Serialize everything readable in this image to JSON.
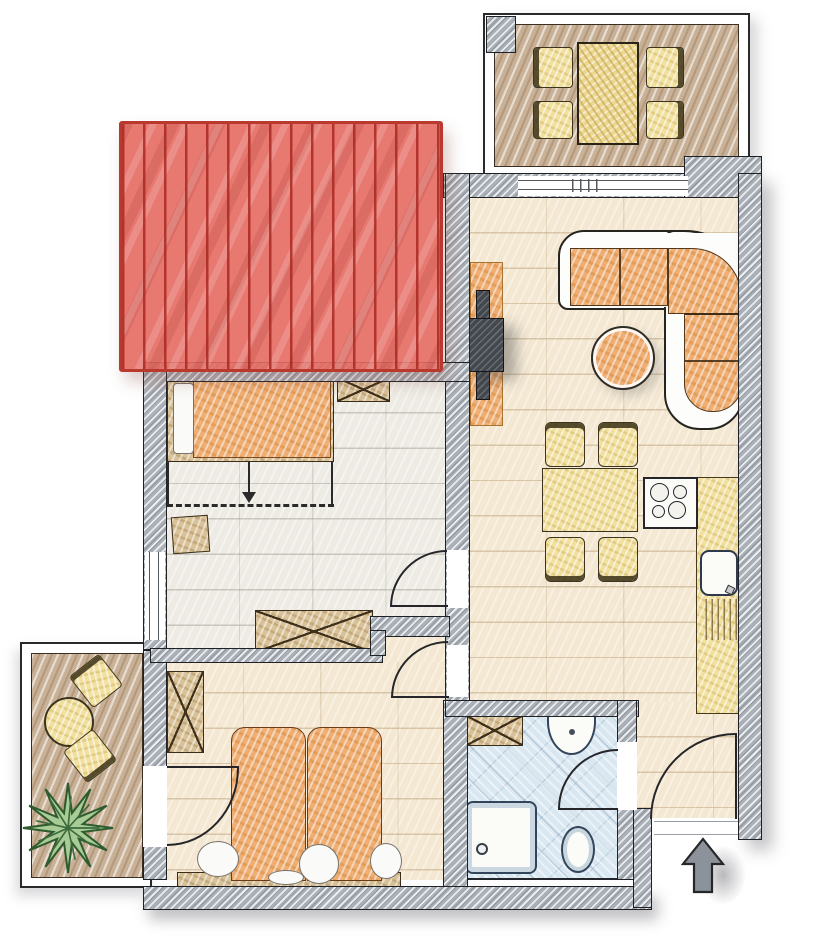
{
  "document": {
    "kind": "apartment floor plan drawing",
    "style": "hand-drawn colored architectural sketch, top view, no text labels"
  },
  "palette": {
    "wall_gray": "#aab0b8",
    "outline": "#26262a",
    "floor_living": "#f4e8d3",
    "floor_bedroom1": "#edebe4",
    "floor_bathroom": "#d9e7f1",
    "floor_deck": "#c9b197",
    "furniture_orange": "#efae73",
    "furniture_yellow": "#f2e09f",
    "furniture_wood": "#d9c298",
    "fixture_white": "#fbfbf8",
    "roof_red": "#e4665c",
    "roof_line_red": "#b0342b",
    "plant_green": "#a9cc97",
    "plant_outline": "#2f5c2f",
    "arrow_gray": "#8b9299"
  },
  "rooms": [
    {
      "id": "balcony-top",
      "type": "balcony",
      "furniture": [
        "rectangular table",
        "4 chairs"
      ],
      "floor": "wood deck"
    },
    {
      "id": "living-kitchen",
      "type": "living room with open kitchen",
      "furniture": [
        "corner sofa",
        "round coffee table",
        "tv sideboard",
        "dining table",
        "4 dining chairs",
        "stove with 4 burners",
        "kitchen counter",
        "sink with drainboard"
      ],
      "floor": "beige tile"
    },
    {
      "id": "bedroom-1",
      "type": "bedroom",
      "furniture": [
        "single bed with pillow",
        "small wardrobe",
        "stool",
        "wardrobe"
      ],
      "annotations": [
        "roof slope dashed line with down arrow"
      ],
      "floor": "pale plank"
    },
    {
      "id": "bedroom-2",
      "type": "bedroom",
      "furniture": [
        "double bed with pillows",
        "wardrobe",
        "headboard bench"
      ],
      "floor": "beige tile"
    },
    {
      "id": "bathroom",
      "type": "bathroom",
      "furniture": [
        "washbasin",
        "cabinet",
        "shower tray",
        "toilet"
      ],
      "floor": "blue tile"
    },
    {
      "id": "terrace-left",
      "type": "terrace",
      "furniture": [
        "round table",
        "2 chairs",
        "plant"
      ],
      "floor": "wood deck"
    },
    {
      "id": "entry-hall",
      "type": "entry",
      "furniture": [
        "entrance door"
      ],
      "floor": "beige tile"
    }
  ],
  "overlays": {
    "roof": {
      "description": "red tiled roof section overlapping upper-left wing",
      "fill": "#e4665c",
      "pattern": "vertical wavy lines"
    }
  },
  "annotations": {
    "entrance_arrow_direction": "up",
    "slope_arrow_direction": "down"
  },
  "doors": [
    {
      "room": "bedroom-1",
      "wall": "east",
      "swing": "into bedroom"
    },
    {
      "room": "bedroom-2",
      "wall": "east",
      "swing": "into bedroom"
    },
    {
      "room": "bedroom-2",
      "wall": "west",
      "swing": "onto terrace side"
    },
    {
      "room": "bathroom",
      "wall": "east",
      "swing": "into bathroom"
    },
    {
      "room": "entry-hall",
      "wall": "south",
      "swing": "into hall"
    }
  ],
  "windows": [
    {
      "room": "bedroom-1",
      "wall": "west"
    },
    {
      "room": "living-kitchen",
      "wall": "north",
      "type": "balcony sliding door"
    }
  ]
}
